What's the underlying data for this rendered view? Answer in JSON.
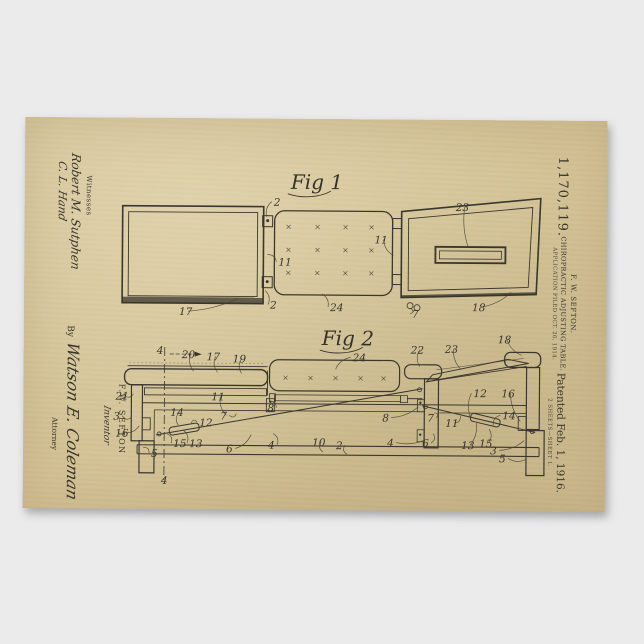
{
  "poster": {
    "patent_number": "1,170,119.",
    "header": {
      "inventor_line": "F. W. SEFTON.",
      "title_line": "CHIROPRACTIC ADJUSTING TABLE.",
      "application_line": "APPLICATION FILED OCT. 26, 1914."
    },
    "patented_line": "Patented Feb. 1, 1916.",
    "sheet_line": "2 SHEETS—SHEET 1.",
    "witnesses": {
      "label": "Witnesses",
      "signatures": [
        "Robert M. Sutphen",
        "C. L. Hand"
      ]
    },
    "inventor_block": {
      "name": "F.W. SEFTON",
      "label": "Inventor"
    },
    "attorney_block": {
      "by": "By",
      "signature": "Watson E. Coleman",
      "label": "Attorney"
    },
    "figures": [
      {
        "label": "Fig 1",
        "x": 266,
        "y": 70,
        "refs": [
          {
            "t": "2",
            "x": 249,
            "y": 87,
            "tx": 242,
            "ty": 98
          },
          {
            "t": "11",
            "x": 254,
            "y": 147,
            "tx": 243,
            "ty": 136
          },
          {
            "t": "2",
            "x": 246,
            "y": 190,
            "tx": 241,
            "ty": 172
          },
          {
            "t": "17",
            "x": 155,
            "y": 197,
            "tx": 214,
            "ty": 180
          },
          {
            "t": "24",
            "x": 306,
            "y": 192,
            "tx": 298,
            "ty": 175
          },
          {
            "t": "11",
            "x": 350,
            "y": 124,
            "tx": 369,
            "ty": 136
          },
          {
            "t": "23",
            "x": 431,
            "y": 91,
            "tx": 444,
            "ty": 128
          },
          {
            "t": "18",
            "x": 448,
            "y": 191,
            "tx": 487,
            "ty": 172
          },
          {
            "t": "7",
            "x": 388,
            "y": 198,
            "tx": 387,
            "ty": 189
          }
        ]
      },
      {
        "label": "Fig 2",
        "x": 298,
        "y": 226,
        "refs": [
          {
            "t": "4",
            "x": 133,
            "y": 236
          },
          {
            "t": "20",
            "x": 158,
            "y": 240,
            "tx": 170,
            "ty": 253
          },
          {
            "t": "17",
            "x": 183,
            "y": 242,
            "tx": 194,
            "ty": 254
          },
          {
            "t": "19",
            "x": 209,
            "y": 244,
            "tx": 218,
            "ty": 255
          },
          {
            "t": "21",
            "x": 92,
            "y": 282,
            "tx": 110,
            "ty": 276
          },
          {
            "t": "3",
            "x": 90,
            "y": 302,
            "tx": 108,
            "ty": 300
          },
          {
            "t": "16",
            "x": 92,
            "y": 319,
            "tx": 116,
            "ty": 308
          },
          {
            "t": "5",
            "x": 128,
            "y": 339,
            "tx": 120,
            "ty": 330
          },
          {
            "t": "14",
            "x": 147,
            "y": 298,
            "tx": 155,
            "ty": 307
          },
          {
            "t": "12",
            "x": 176,
            "y": 308,
            "tx": 168,
            "ty": 305
          },
          {
            "t": "11",
            "x": 188,
            "y": 282,
            "tx": 203,
            "ty": 297
          },
          {
            "t": "7",
            "x": 197,
            "y": 301,
            "tx": 213,
            "ty": 295
          },
          {
            "t": "15",
            "x": 150,
            "y": 329,
            "tx": 144,
            "ty": 316
          },
          {
            "t": "13",
            "x": 166,
            "y": 329,
            "tx": 160,
            "ty": 312
          },
          {
            "t": "6",
            "x": 203,
            "y": 334,
            "tx": 228,
            "ty": 316
          },
          {
            "t": "4",
            "x": 245,
            "y": 330,
            "tx": 250,
            "ty": 315
          },
          {
            "t": "8",
            "x": 244,
            "y": 293,
            "tx": 246,
            "ty": 283
          },
          {
            "t": "10",
            "x": 289,
            "y": 327,
            "tx": 300,
            "ty": 333
          },
          {
            "t": "2",
            "x": 313,
            "y": 330,
            "tx": 324,
            "ty": 335
          },
          {
            "t": "24",
            "x": 329,
            "y": 242,
            "tx": 312,
            "ty": 250
          },
          {
            "t": "22",
            "x": 387,
            "y": 234,
            "tx": 396,
            "ty": 247
          },
          {
            "t": "23",
            "x": 421,
            "y": 233,
            "tx": 437,
            "ty": 249
          },
          {
            "t": "18",
            "x": 474,
            "y": 223,
            "tx": 498,
            "ty": 235
          },
          {
            "t": "8",
            "x": 359,
            "y": 302,
            "tx": 395,
            "ty": 287
          },
          {
            "t": "7",
            "x": 404,
            "y": 302,
            "tx": 411,
            "ty": 293
          },
          {
            "t": "4",
            "x": 364,
            "y": 327,
            "tx": 402,
            "ty": 320
          },
          {
            "t": "6",
            "x": 399,
            "y": 327,
            "tx": 410,
            "ty": 314
          },
          {
            "t": "11",
            "x": 422,
            "y": 307,
            "tx": 437,
            "ty": 296
          },
          {
            "t": "12",
            "x": 450,
            "y": 277,
            "tx": 447,
            "ty": 297
          },
          {
            "t": "16",
            "x": 478,
            "y": 277,
            "tx": 497,
            "ty": 301
          },
          {
            "t": "14",
            "x": 479,
            "y": 299,
            "tx": 470,
            "ty": 305
          },
          {
            "t": "13",
            "x": 438,
            "y": 329,
            "tx": 453,
            "ty": 303
          },
          {
            "t": "15",
            "x": 456,
            "y": 327,
            "tx": 466,
            "ty": 309
          },
          {
            "t": "3",
            "x": 467,
            "y": 334,
            "tx": 501,
            "ty": 320
          },
          {
            "t": "5",
            "x": 476,
            "y": 342,
            "tx": 503,
            "ty": 339
          },
          {
            "t": "4",
            "x": 138,
            "y": 366
          }
        ]
      }
    ]
  },
  "colors": {
    "background": "#ecebec",
    "paper": "#d4c397",
    "ink": "#3a372e"
  }
}
